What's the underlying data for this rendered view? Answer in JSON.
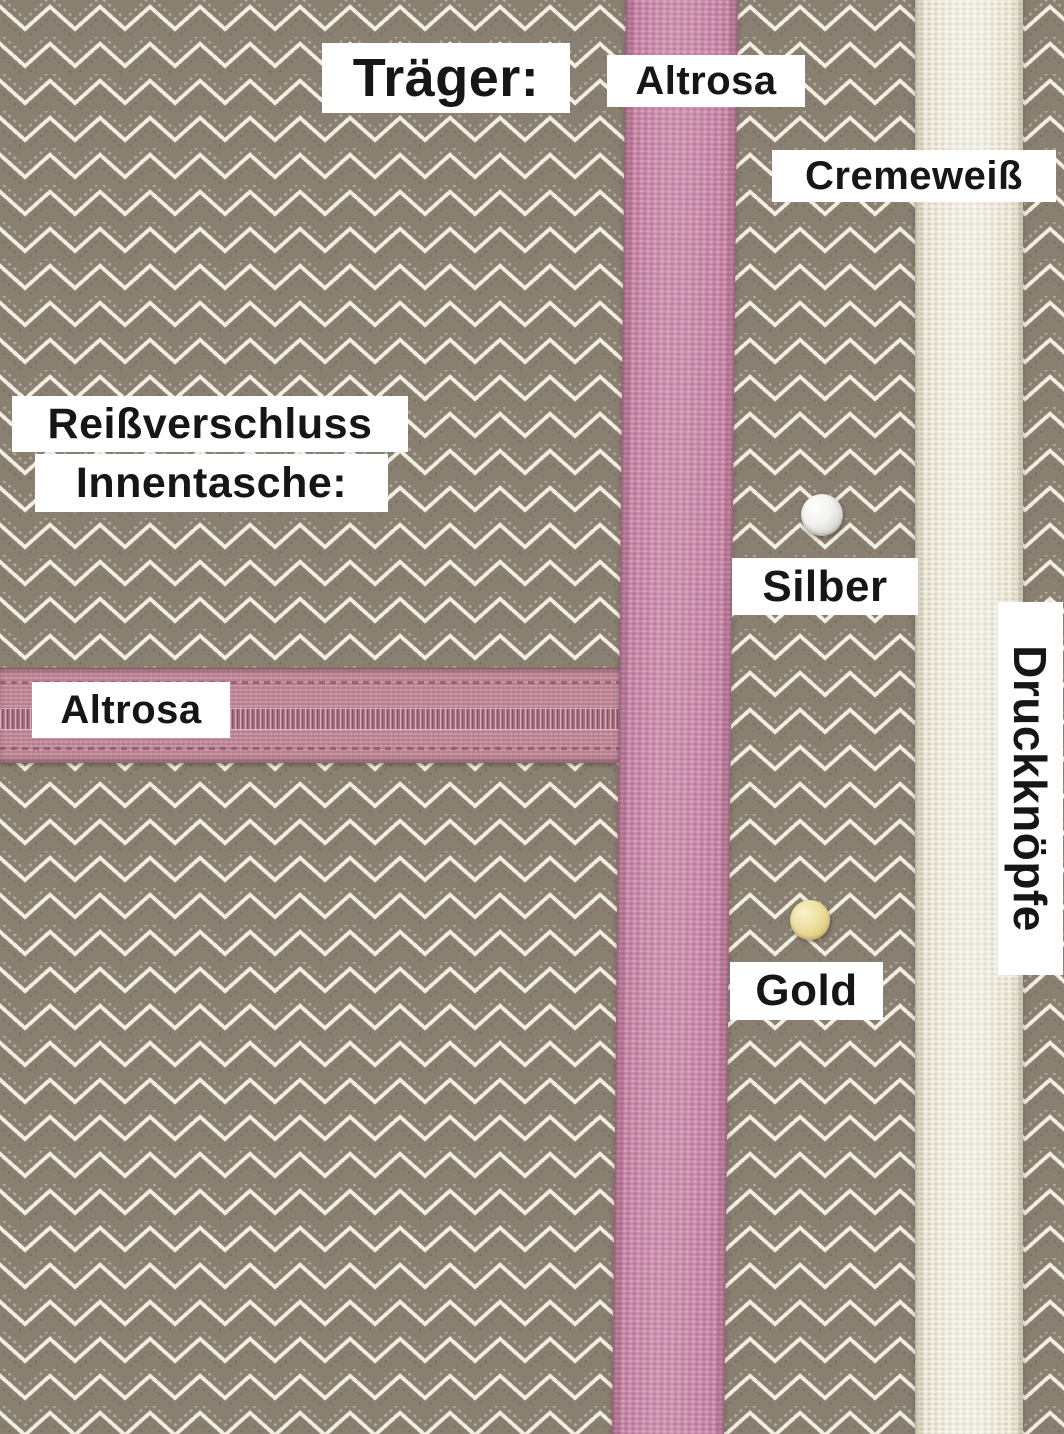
{
  "photo": {
    "description": "Material options board: herringbone fabric with strap, zipper and snap-button colour choices",
    "width_px": 1064,
    "height_px": 1434
  },
  "sections": {
    "straps": {
      "heading": "Träger:",
      "options": [
        {
          "label": "Altrosa",
          "color": "#c786a6"
        },
        {
          "label": "Cremeweiß",
          "color": "#eae5d4"
        }
      ]
    },
    "zipper": {
      "heading_line1": "Reißverschluss",
      "heading_line2": "Innentasche:",
      "option": {
        "label": "Altrosa",
        "color": "#bf8495"
      }
    },
    "snaps": {
      "heading": "Druckknöpfe",
      "options": [
        {
          "label": "Silber",
          "color": "#e4e4e0"
        },
        {
          "label": "Gold",
          "color": "#e7dd9b"
        }
      ]
    }
  },
  "colors": {
    "fabric_base": "#8a8072",
    "fabric_weave_light": "#f2eee2",
    "label_bg": "#ffffff",
    "label_text": "#161616",
    "zipper_tape": "#bf8495",
    "zipper_coil": "#a66c7f",
    "snap_silver": "#e4e4e0",
    "snap_gold": "#e7dd9b"
  }
}
